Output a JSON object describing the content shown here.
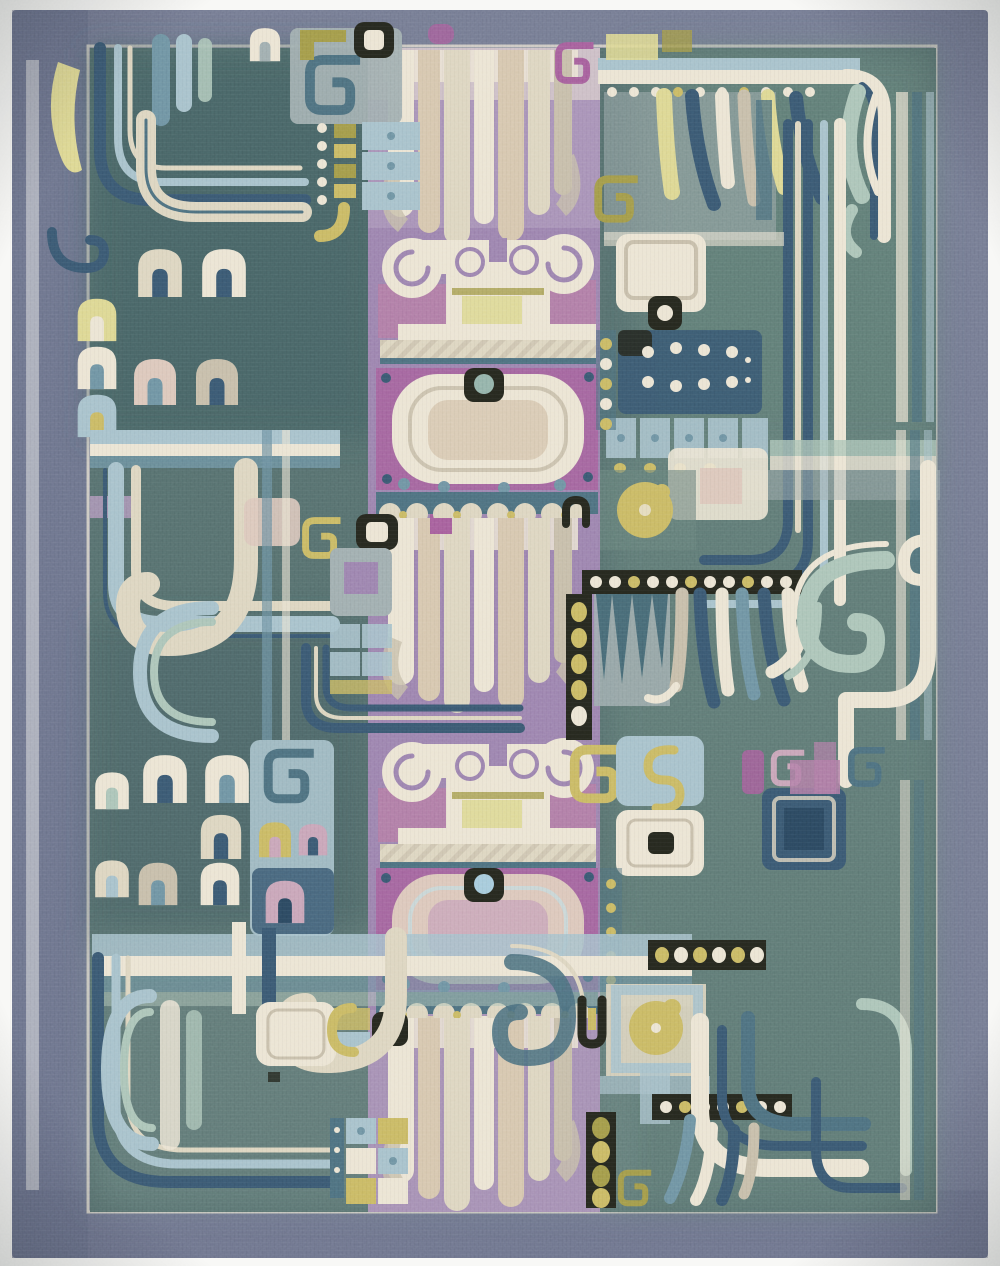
{
  "image": {
    "type": "photograph",
    "subject": "antique carpet",
    "description": "Antique hand-knotted carpet photographed flat: abstract archaistic bronze-style motifs (scroll crests, mask medallions, feather cascades, meander hooks, arch motifs, dotted bands, banner ribbons, rosettes, tile columns) on a teal-green field with a central lavender-purple panel and a slate blue-grey plain border.",
    "orientation": "portrait"
  },
  "rug": {
    "border_style": "plain slate blue-grey band with pale inner guard stripe",
    "field_style": "teal green-grey abstract patchwork",
    "central_panel": "lavender purple column with cream feather cascades, two scroll crests and two mask medallions",
    "motifs": [
      "scroll-crest",
      "mask-medallion",
      "feather-cascade",
      "meander-scroll",
      "arch-motif",
      "banner-ribbons",
      "dotted-band",
      "rosette",
      "tile-column",
      "hook-band",
      "scallop-band",
      "eye-motif"
    ]
  },
  "palette": {
    "bg": "#f8f8f6",
    "border": "#747a92",
    "borderDark": "#646b85",
    "borderPale": "#b5b8c3",
    "field": "#566f6e",
    "fieldDark": "#455f62",
    "fieldGreen": "#67827b",
    "fieldLight": "#8aa09a",
    "panelGray": "#9fadaf",
    "steel": "#6e92a2",
    "navy": "#3a5871",
    "navyDark": "#2c4860",
    "lightBlue": "#a6c1cb",
    "paleBlue": "#c6d7d9",
    "seafoam": "#abc4b8",
    "tealBand": "#4d6f7e",
    "tealDark": "#3f6470",
    "cream": "#ddd5c0",
    "creamLight": "#ebe4d3",
    "creamDark": "#c6bda9",
    "beige": "#d6c6ae",
    "pinkBeige": "#dcc7bb",
    "paleYellow": "#ddd792",
    "gold": "#c9b964",
    "olive": "#a29a4a",
    "purple": "#9b82ae",
    "purpleLight": "#b4a0c0",
    "lilac": "#ab97b8",
    "rose": "#b07ca6",
    "magenta": "#a55f9b",
    "pink": "#c8a4b8",
    "ink": "#26281f",
    "eyeTeal": "#92b2a9",
    "eyeBlue": "#a5cadb"
  }
}
